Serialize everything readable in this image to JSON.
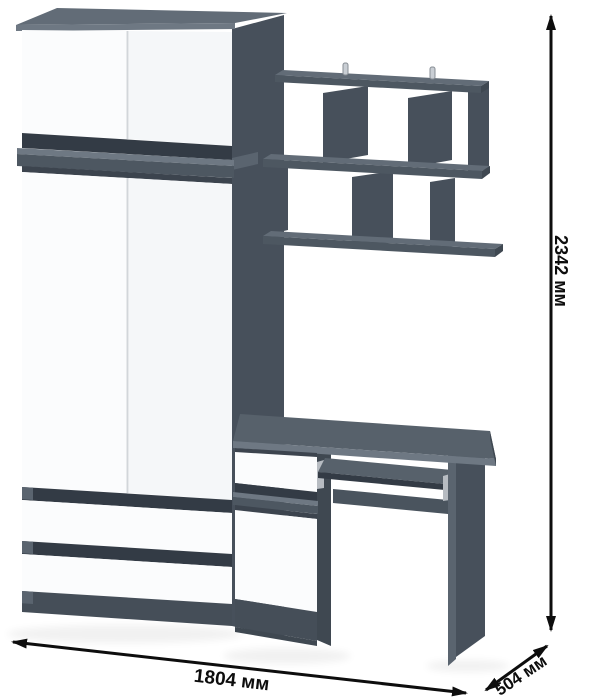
{
  "diagram": {
    "kind": "furniture set 3D dimension diagram",
    "pieces": [
      "wardrobe",
      "wall-shelf",
      "computer-desk"
    ]
  },
  "dimensions": {
    "height": "2342 мм",
    "width": "1804 мм",
    "depth": "504 мм"
  },
  "palette": {
    "background": "#ffffff",
    "graphite_top_surface": "#626c77",
    "desktop_top": "#57616b",
    "graphite_front_edge": "#4d5761",
    "graphite_side_panel": "#47505b",
    "graphite_dark_end": "#3f4851",
    "recess_strip": "#333b45",
    "plinth": "#454e58",
    "ledge_highlight": "#6e7883",
    "cap_highlight": "#5a646f",
    "under_ledge_shadow": "#3c444e",
    "back_panel": "#4a545e",
    "white_front": "#fbfcfd",
    "white_front_shaded": "#f5f7f9",
    "door_seam": "#d2d6da",
    "metal_rail": "#b7bcc2",
    "dimension_line": "#0d0d0d"
  }
}
